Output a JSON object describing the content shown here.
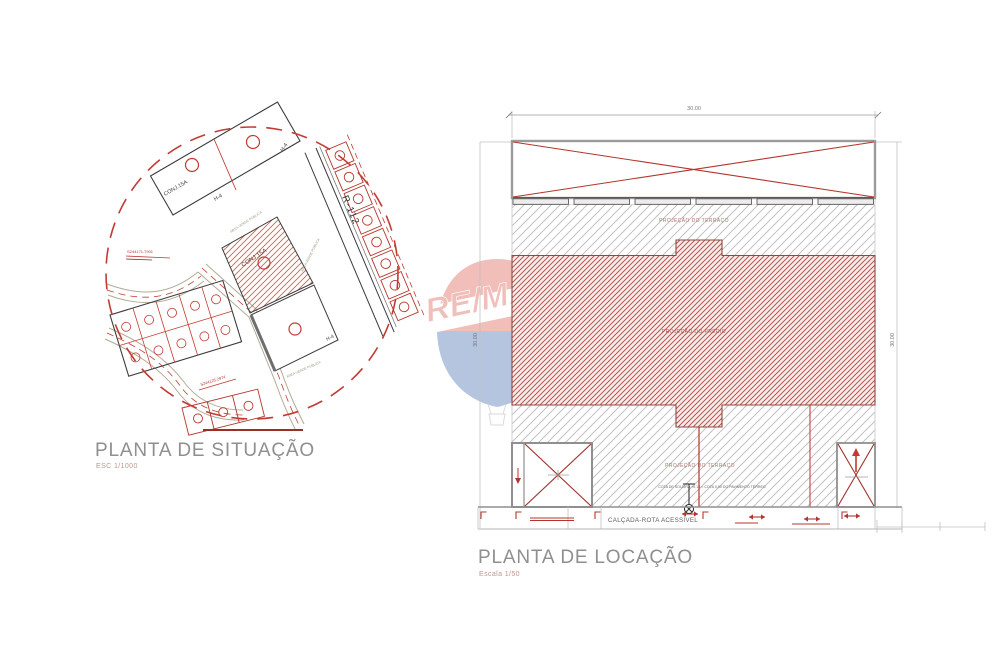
{
  "situation_plan": {
    "title": "PLANTA DE SITUAÇÃO",
    "scale_note": "ESC 1/1000",
    "labels": {
      "conj_upper": "CONJ.15A",
      "h4_upper": "H-4",
      "h4_mid": "H-4",
      "street": "R-112",
      "conj_hatched": "CONJ.15A",
      "h4_lower": "H-4",
      "green_area_1": "ÁREA VERDE PÚBLICA",
      "green_area_2": "ÁREA VERDE PÚBLICA",
      "green_area_3": "ÁREA VERDE PÚBLICA",
      "coord_north": "S244171.7901",
      "coord_south": "S244125.2974"
    }
  },
  "location_plan": {
    "title": "PLANTA DE LOCAÇÃO",
    "scale_note": "Escala 1/50",
    "dimensions": {
      "top": "30.00",
      "left": "30.00",
      "right": "30.00"
    },
    "labels": {
      "terrace_upper": "PROJEÇÃO DO TERRAÇO",
      "building": "PROJEÇÃO DO PRÉDIO",
      "terrace_lower": "PROJEÇÃO DO TERRAÇO",
      "threshold_note": "COTA DE SOLEIRA +0,15 = COTA 0,00 DO PAVIMENTO TÉRREO",
      "sidewalk": "CALÇADA-ROTA ACESSÍVEL"
    }
  },
  "watermark": {
    "wordmark": "RE/MAX"
  },
  "colors": {
    "drawing_red": "#b4352c",
    "hatch_red": "#b45a52",
    "hatch_gray": "#c2c2c2",
    "line_black": "#3c3c3c",
    "wall_gray": "#9b9b9b",
    "road_tan": "#b3ab97",
    "title_gray": "#8f8f8f",
    "scale_note_red": "#bd968e",
    "balloon_red": "#d5392b",
    "balloon_blue": "#1d4f9e"
  }
}
